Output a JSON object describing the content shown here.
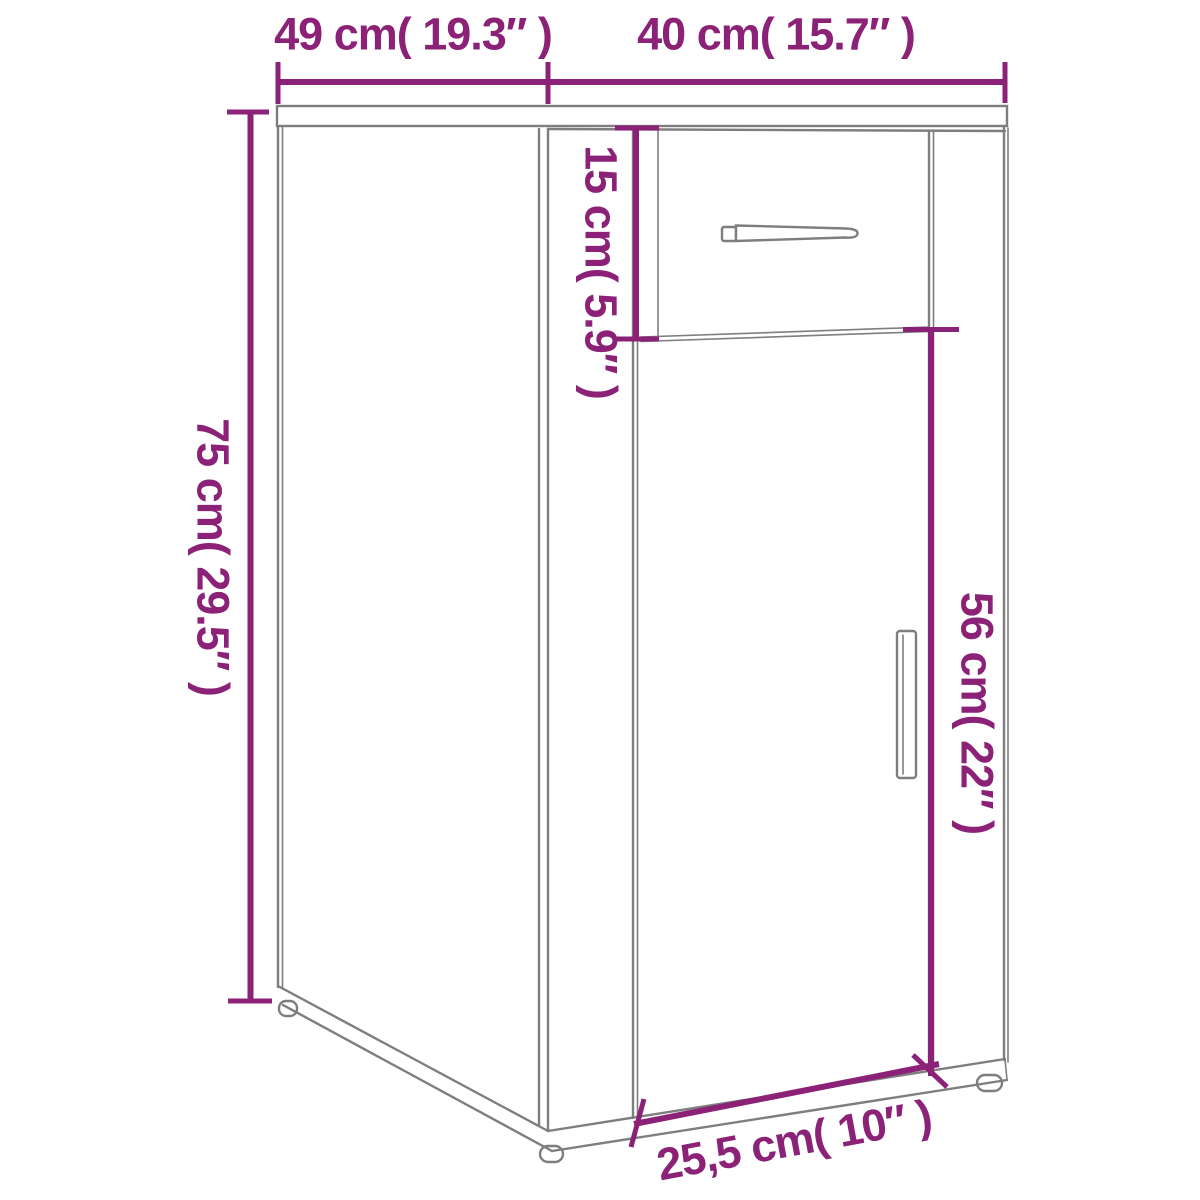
{
  "diagram": {
    "kind": "furniture-dimension-line-drawing",
    "colors": {
      "dimension_lines": "#8b2277",
      "outline": "#7e7e7e",
      "background": "#ffffff"
    },
    "dimensions": [
      {
        "name": "depth",
        "label": "49 cm( 19.3″ )",
        "cm": "49",
        "inch": "19.3″"
      },
      {
        "name": "width",
        "label": "40 cm( 15.7″ )",
        "cm": "40",
        "inch": "15.7″"
      },
      {
        "name": "height",
        "label": "75 cm( 29.5″ )",
        "cm": "75",
        "inch": "29.5″"
      },
      {
        "name": "drawer-height",
        "label": "15 cm( 5.9″ )",
        "cm": "15",
        "inch": "5.9″"
      },
      {
        "name": "door-height",
        "label": "56 cm( 22″ )",
        "cm": "56",
        "inch": "22″"
      },
      {
        "name": "base-width",
        "label": "25,5 cm( 10″ )",
        "cm": "25,5",
        "inch": "10″"
      }
    ]
  }
}
